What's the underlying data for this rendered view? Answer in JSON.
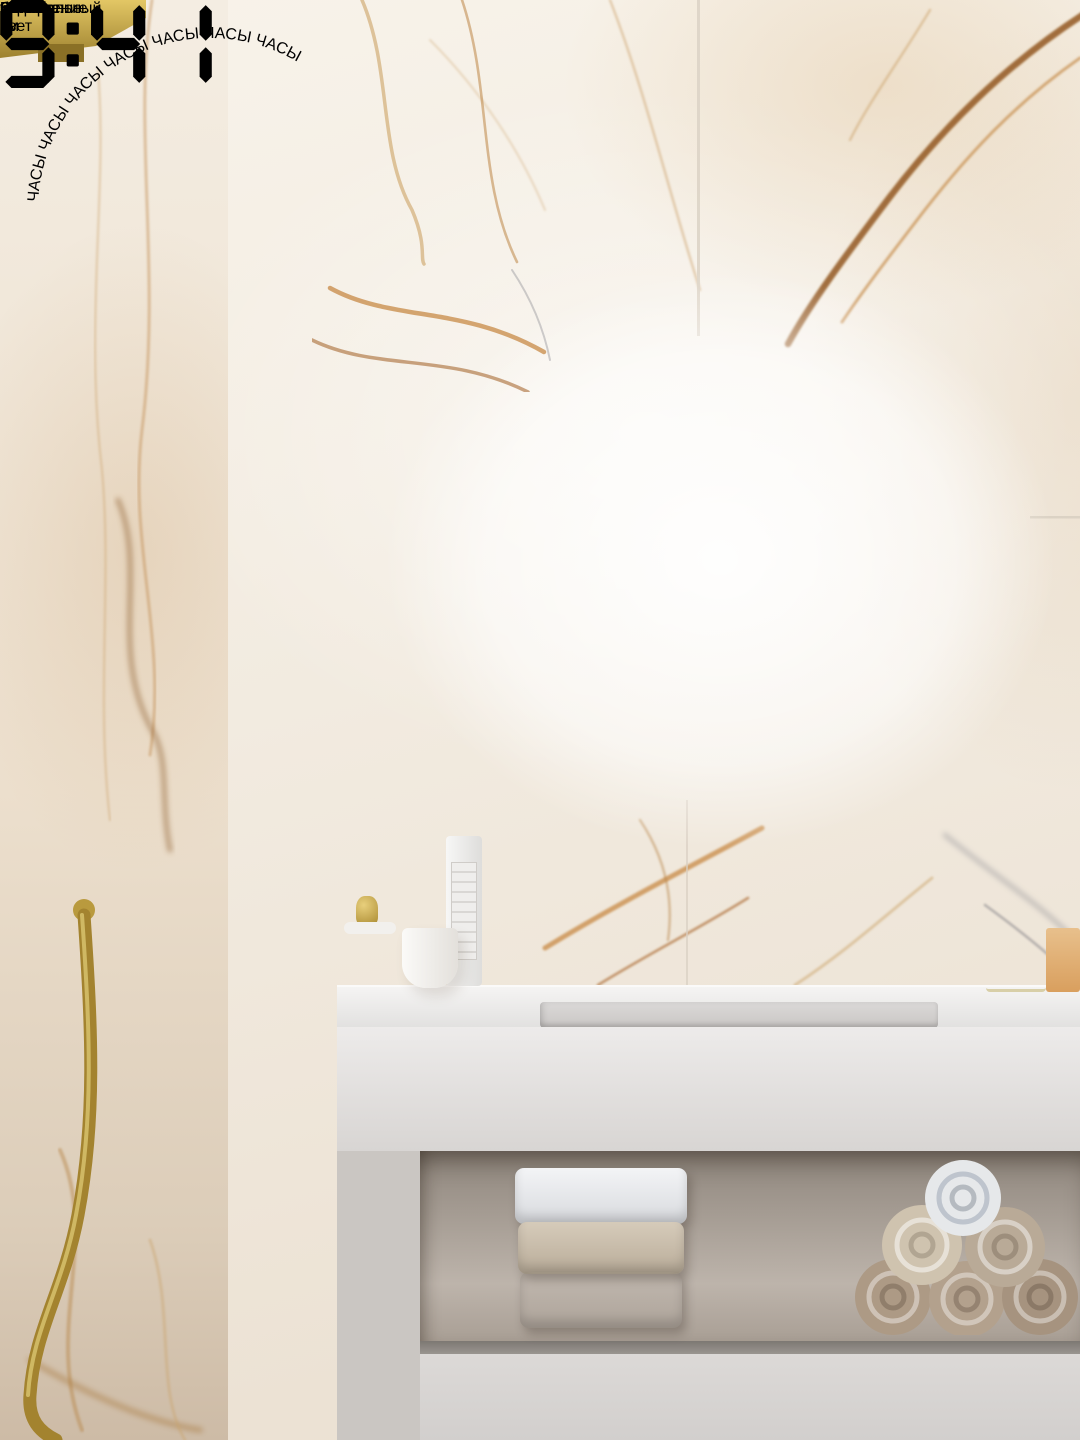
{
  "badges": [
    {
      "label": "Высота:",
      "value": "60 см"
    },
    {
      "label": "Ширина:",
      "value": "80 см"
    },
    {
      "line1": "Сенсорное",
      "line2": "управление"
    },
    {
      "line1": "Нейтральный",
      "line2": "белый свет"
    }
  ],
  "mirror": {
    "clock_time": "9:41"
  },
  "watermark": {
    "ring_text": "ЧАСЫ  ЧАСЫ  ЧАСЫ  ЧАСЫ  ЧАСЫ  ЧАСЫ  ЧАСЫ",
    "time": "9:41"
  },
  "colors": {
    "badge_text": "#4d3827",
    "frame_gold": "#c8a845",
    "led_white": "#ffffff",
    "watermark_tint": "rgba(171,159,95,0.58)",
    "watermark_text": "#f1ebc4"
  }
}
